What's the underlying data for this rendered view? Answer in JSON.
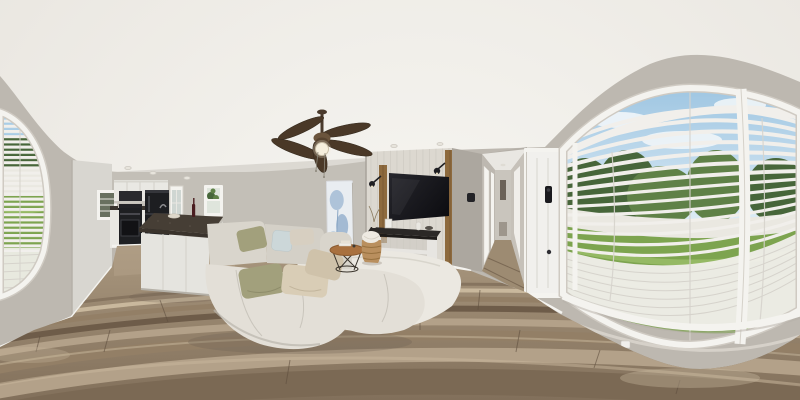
{
  "scene": {
    "type": "equirectangular-360-panorama",
    "setting": "staged open-concept interior: kitchen with island, living room with sectional sofa and wall TV, hallway with front door, large bowed windows with venetian blinds looking onto a fenced backyard lawn",
    "elements": [
      "ceiling",
      "ceiling-fan",
      "recessed-lights",
      "left-window-blinds",
      "pantry-wall",
      "kitchen-cabinets",
      "range-hood",
      "stove",
      "refrigerator",
      "back-door",
      "kitchen-island",
      "wine-bottle",
      "small-window",
      "abstract-painting",
      "sectional-sofa",
      "throw-pillows",
      "area-rug",
      "coffee-table",
      "storage-basket",
      "tv-accent-wall",
      "wall-mounted-tv",
      "wall-sconces",
      "console-table",
      "thermostat",
      "hallway",
      "interior-doors",
      "front-door",
      "smart-lock",
      "right-window-blinds",
      "window-mullion",
      "backyard-view",
      "white-fence",
      "lawn",
      "trees",
      "sky",
      "wood-plank-floor",
      "wall-outlet"
    ]
  },
  "colors": {
    "ceiling": "#f2f0ec",
    "wall": "#bdb8b0",
    "wall_light": "#c9c5bd",
    "wall_dark": "#aca79f",
    "trim": "#f4f3ef",
    "door": "#f1f0ed",
    "accent_panel": "#dcd8d0",
    "accent_line": "#c9c5bd",
    "wood_strip": "#8d6a3e",
    "pantry": "#d8d6d0",
    "cabinet": "#e9e8e3",
    "appliance": "#1e1f22",
    "island_top": "#463e35",
    "island_base": "#e5e4df",
    "floor_base": "#9b8870",
    "floor_dark": "#7b6954",
    "floor_mid": "#937f66",
    "floor_light": "#b3a189",
    "floor_pale": "#c9b89d",
    "plank_seam": "#5f4f3f",
    "rug": "#ebe8e1",
    "sofa": "#d9d5cc",
    "sofa_light": "#e3dfd7",
    "sofa_shadow": "#b9b5ac",
    "pillow_olive": "#a2a07c",
    "pillow_beige": "#d9cdb6",
    "pillow_blue": "#ccd7d9",
    "pillow_cream": "#d7cfc1",
    "table_wood": "#a9713f",
    "basket": "#b98f5e",
    "blanket": "#eeeae2",
    "tv": "#141417",
    "console_top": "#2b2826",
    "console_body": "#e7e5e1",
    "blind": "#f1efeb",
    "blind_line": "#d6d3cc",
    "sky": "#a9cde6",
    "cloud": "#f4f8fa",
    "tree": "#47663a",
    "tree_light": "#5f8147",
    "fence": "#eae8e1",
    "grass": "#7da44f",
    "grass_light": "#95b964",
    "painting": "#e9edf1",
    "paint_blue": "#84a4c6",
    "fan_blade": "#4a3827",
    "fan_body": "#6b543c",
    "fan_glass": "#f6efdd",
    "metal_black": "#1e1e22",
    "shadow": "#6e6152"
  }
}
